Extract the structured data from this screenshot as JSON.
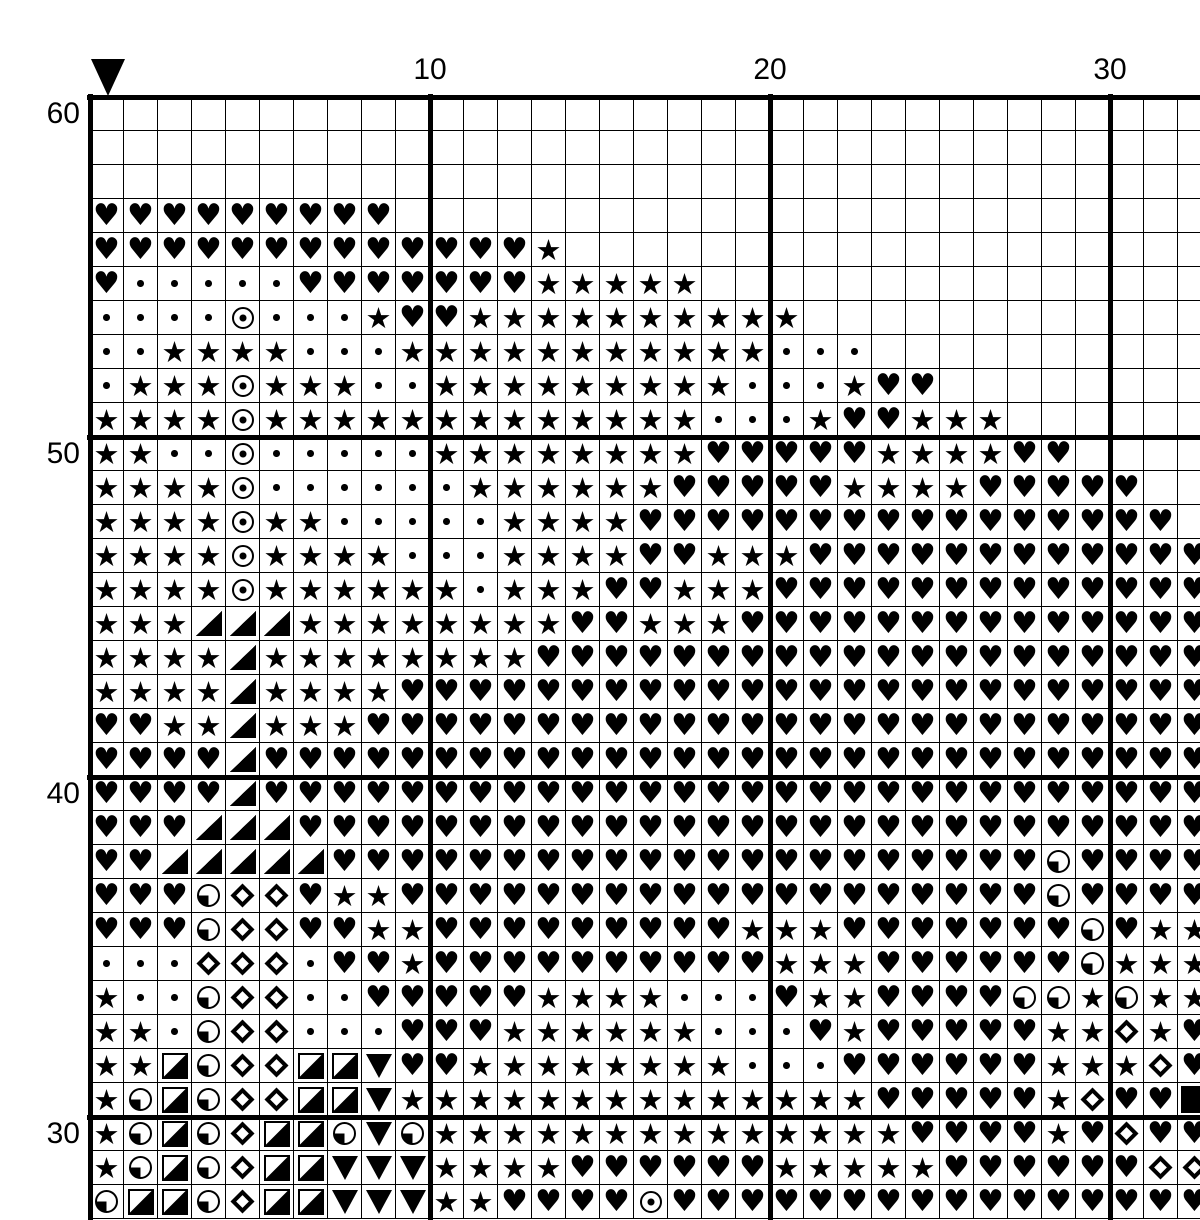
{
  "page": {
    "background": "#ffffff",
    "ink": "#000000",
    "description": "Black-and-white cross-stitch pattern chart page"
  },
  "marker": {
    "label": "center-column-marker",
    "shape": "down-triangle",
    "column": 1
  },
  "axis": {
    "row_labels": [
      {
        "text": "60",
        "row_offset": 0
      },
      {
        "text": "50",
        "row_offset": 10
      },
      {
        "text": "40",
        "row_offset": 20
      },
      {
        "text": "30",
        "row_offset": 30
      }
    ],
    "col_labels": [
      {
        "text": "10",
        "col_offset": 10
      },
      {
        "text": "20",
        "col_offset": 20
      },
      {
        "text": "30",
        "col_offset": 30
      }
    ]
  },
  "legend": {
    ".": "empty",
    "H": "heart",
    "S": "star",
    "d": "small-dot",
    "O": "circled-dot",
    "Q": "quarter-circle-lower-left",
    "T": "half-square-triangle",
    "D": "diamond-outline",
    "R": "square-diagonal-half",
    "V": "down-triangle",
    "B": "solid-square"
  },
  "glyphs": {
    "heart": "♥",
    "star": "★"
  },
  "grid": {
    "columns": 33,
    "rows": 33,
    "bold_every": 10,
    "cell_size": 34,
    "cell_codes": [
      ".................................",
      ".................................",
      ".................................",
      "HHHHHHHHH........................",
      "HHHHHHHHHHHHHS...................",
      "HdddddHHHHHHHSSSSS...............",
      "ddddOdddSHHSSSSSSSSSS............",
      "ddSSSSdddSSSSSSSSSSSddd..........",
      "dSSSOSSSddSSSSSSSSSdddSHH........",
      "SSSSOSSSSSSSSSSSSSdddSHHSSS......",
      "SSddOdddddSSSSSSSSHHHHHSSSSHH....",
      "SSSSOddddddSSSSSSHHHHHSSSSHHHHH..",
      "SSSSOSSdddddSSSSHHHHHHHHHHHHHHHH.",
      "SSSSOSSSSdddSSSSHHSSSHHHHHHHHHHHH",
      "SSSSOSSSSSSdSSSHHSSSHHHHHHHHHHHHH",
      "SSSTTTSSSSSSSSHHSSSHHHHHHHHHHHHHH",
      "SSSSTSSSSSSSSHHHHHHHHHHHHHHHHHHHH",
      "SSSSTSSSSHHHHHHHHHHHHHHHHHHHHHHHH",
      "HHSSTSSSHHHHHHHHHHHHHHHHHHHHHHHHH",
      "HHHHTHHHHHHHHHHHHHHHHHHHHHHHHHHHH",
      "HHHHTHHHHHHHHHHHHHHHHHHHHHHHHHHHH",
      "HHHTTTHHHHHHHHHHHHHHHHHHHHHHHHHHH",
      "HHTTTTTHHHHHHHHHHHHHHHHHHHHHQHHHH",
      "HHHQDDHSSHHHHHHHHHHHHHHHHHHHQHHHH",
      "HHHQDDHHSSHHHHHHHHHSSSHHHHHHHQHSS",
      "dddDDDdHHSHHHHHHHHHHSSSHHHHHHQSSS",
      "SddQDDddHHHHHSSSSdddHSSHHHHQQSQSS",
      "SSdQDDdddHHHSSSSSSdddHSHHHHHSSDSH",
      "SSRQDDRRVHHSSSSSSSSdddHHHHHHSSSDH",
      "SQRQDDRRVSSSSSSSSSSSSSSHHHHHSDHHB",
      "SQRQDRRQVQSSSSSSSSSSSSSSHHHHSHDHH",
      "SQRQDRRVVVSSSSHHHHHHSSSSSHHHHHHDD",
      "QRRQDRRVVVSSHHHHOHHHHHHHHHHHHHHHH"
    ]
  }
}
